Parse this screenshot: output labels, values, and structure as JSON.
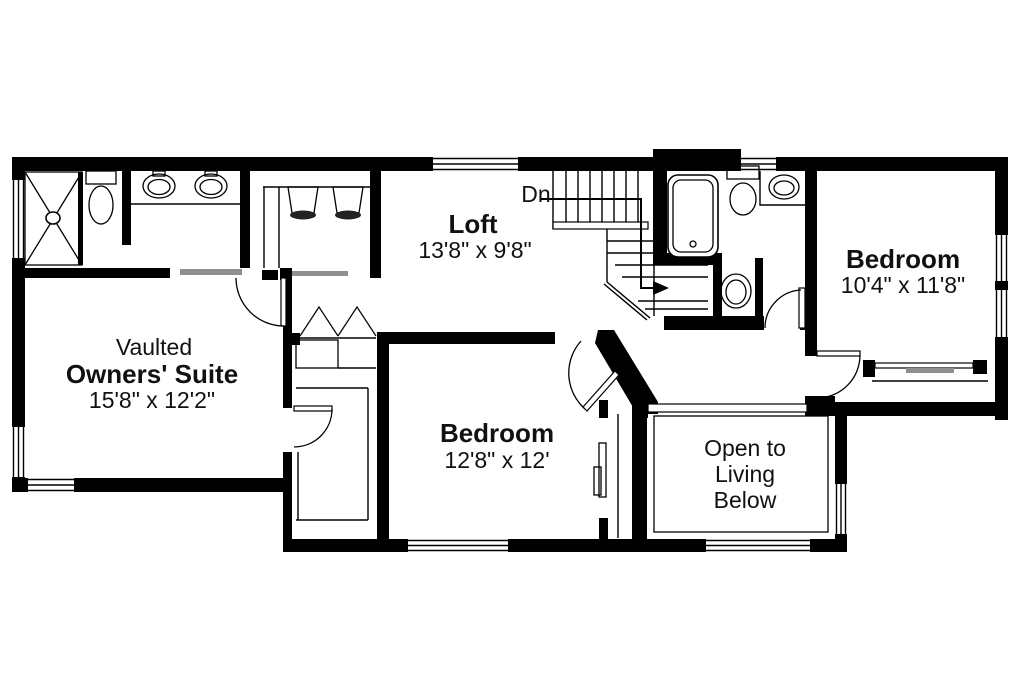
{
  "plan": {
    "type": "second-floor-plan",
    "rooms": {
      "owners_suite": {
        "prefix": "Vaulted",
        "name": "Owners' Suite",
        "dims": "15'8\" x 12'2\""
      },
      "loft": {
        "name": "Loft",
        "dims": "13'8\" x 9'8\""
      },
      "bedroom_right": {
        "name": "Bedroom",
        "dims": "10'4\" x 11'8\""
      },
      "bedroom_middle": {
        "name": "Bedroom",
        "dims": "12'8\" x 12'"
      },
      "open_below": {
        "line1": "Open to",
        "line2": "Living",
        "line3": "Below"
      }
    },
    "stairs": {
      "direction_label": "Dn"
    },
    "fixture_icons": [
      "shower-icon",
      "toilet-icon",
      "double-vanity-sink-icon",
      "hanging-clothes-icon",
      "bathtub-icon",
      "corner-sink-icon",
      "pedestal-sink-icon",
      "staircase-icon",
      "door-swing-icon",
      "bifold-door-icon",
      "bypass-door-icon",
      "window-icon",
      "railing-icon"
    ],
    "colors": {
      "wall": "#000000",
      "background": "#ffffff",
      "door_panel_gray": "#8f8f8f"
    }
  }
}
